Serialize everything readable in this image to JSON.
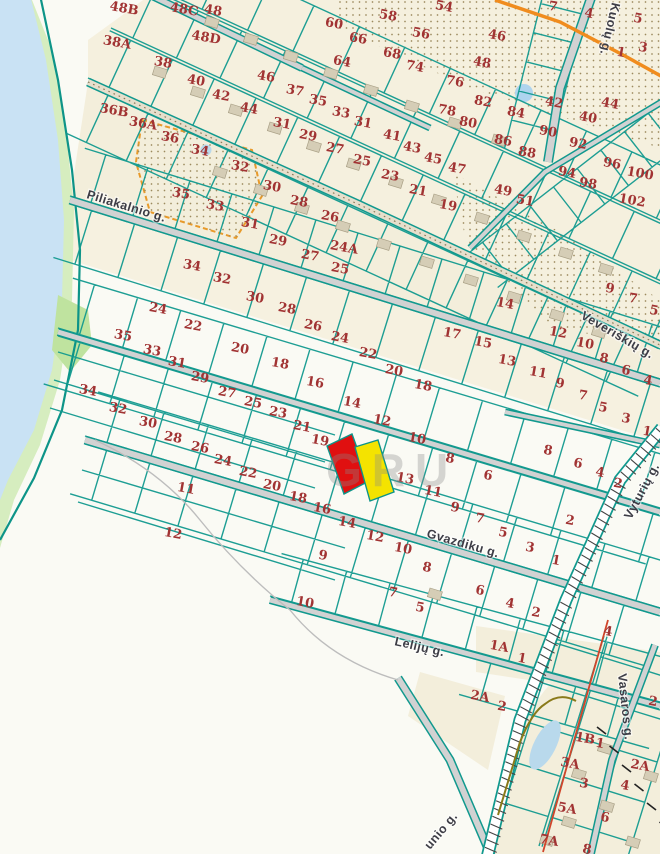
{
  "map": {
    "watermark": "GRU",
    "colors": {
      "parcel_line": "#11998e",
      "number": "#a13333",
      "street_label": "#3d3d46",
      "highlight_red": "#e01010",
      "highlight_yellow": "#f4e300",
      "road_fill": "#d2d2d2",
      "river": "#c9e2f4",
      "greenery": "#d6edbf",
      "beige": "#f3eedb",
      "orange_road": "#f08c1e",
      "watermark_gray": "#8a8a8a"
    },
    "streets": [
      {
        "name": "Piliakalnio g.",
        "x": 86,
        "y": 198,
        "rot": 17
      },
      {
        "name": "Gvazdiku g.",
        "x": 426,
        "y": 537,
        "rot": 16
      },
      {
        "name": "Lelijų g.",
        "x": 394,
        "y": 645,
        "rot": 13
      },
      {
        "name": "Veveriškių g.",
        "x": 580,
        "y": 318,
        "rot": 30
      },
      {
        "name": "Kuolų g.",
        "x": 612,
        "y": 2,
        "rot": 103
      },
      {
        "name": "Vyturių g.",
        "x": 631,
        "y": 520,
        "rot": -62
      },
      {
        "name": "Vasaros g.",
        "x": 618,
        "y": 674,
        "rot": 84
      },
      {
        "name": "unio g.",
        "x": 430,
        "y": 850,
        "rot": -50
      }
    ],
    "highlighted_parcels": [
      {
        "id": "selected-parcel-red",
        "color": "#e01010"
      },
      {
        "id": "adjacent-parcel-yellow",
        "color": "#f4e300"
      }
    ],
    "parcel_labels": [
      {
        "t": "48B",
        "x": 124,
        "y": 9
      },
      {
        "t": "48C",
        "x": 184,
        "y": 10
      },
      {
        "t": "48",
        "x": 213,
        "y": 11
      },
      {
        "t": "48D",
        "x": 206,
        "y": 38
      },
      {
        "t": "38A",
        "x": 117,
        "y": 43
      },
      {
        "t": "38",
        "x": 163,
        "y": 63
      },
      {
        "t": "40",
        "x": 196,
        "y": 81
      },
      {
        "t": "42",
        "x": 221,
        "y": 96
      },
      {
        "t": "44",
        "x": 249,
        "y": 109
      },
      {
        "t": "46",
        "x": 266,
        "y": 77
      },
      {
        "t": "36B",
        "x": 114,
        "y": 111
      },
      {
        "t": "36A",
        "x": 143,
        "y": 124
      },
      {
        "t": "36",
        "x": 170,
        "y": 138
      },
      {
        "t": "34",
        "x": 200,
        "y": 151
      },
      {
        "t": "32",
        "x": 240,
        "y": 167
      },
      {
        "t": "31",
        "x": 282,
        "y": 124
      },
      {
        "t": "30",
        "x": 272,
        "y": 187
      },
      {
        "t": "28",
        "x": 299,
        "y": 202
      },
      {
        "t": "26",
        "x": 330,
        "y": 217
      },
      {
        "t": "24A",
        "x": 344,
        "y": 248
      },
      {
        "t": "35",
        "x": 181,
        "y": 194
      },
      {
        "t": "33",
        "x": 215,
        "y": 206
      },
      {
        "t": "31",
        "x": 250,
        "y": 224
      },
      {
        "t": "29",
        "x": 278,
        "y": 241
      },
      {
        "t": "27",
        "x": 310,
        "y": 256
      },
      {
        "t": "25",
        "x": 340,
        "y": 269
      },
      {
        "t": "29",
        "x": 308,
        "y": 136
      },
      {
        "t": "27",
        "x": 335,
        "y": 149
      },
      {
        "t": "25",
        "x": 362,
        "y": 161
      },
      {
        "t": "23",
        "x": 390,
        "y": 176
      },
      {
        "t": "21",
        "x": 418,
        "y": 191
      },
      {
        "t": "19",
        "x": 448,
        "y": 206
      },
      {
        "t": "37",
        "x": 295,
        "y": 91
      },
      {
        "t": "35",
        "x": 318,
        "y": 101
      },
      {
        "t": "33",
        "x": 341,
        "y": 113
      },
      {
        "t": "31",
        "x": 363,
        "y": 123
      },
      {
        "t": "41",
        "x": 392,
        "y": 136
      },
      {
        "t": "43",
        "x": 412,
        "y": 148
      },
      {
        "t": "45",
        "x": 433,
        "y": 159
      },
      {
        "t": "47",
        "x": 457,
        "y": 169
      },
      {
        "t": "49",
        "x": 503,
        "y": 191
      },
      {
        "t": "51",
        "x": 525,
        "y": 201
      },
      {
        "t": "54",
        "x": 444,
        "y": 7
      },
      {
        "t": "56",
        "x": 421,
        "y": 34
      },
      {
        "t": "58",
        "x": 388,
        "y": 16
      },
      {
        "t": "60",
        "x": 334,
        "y": 24
      },
      {
        "t": "64",
        "x": 342,
        "y": 62
      },
      {
        "t": "66",
        "x": 358,
        "y": 39
      },
      {
        "t": "68",
        "x": 392,
        "y": 54
      },
      {
        "t": "74",
        "x": 415,
        "y": 67
      },
      {
        "t": "76",
        "x": 455,
        "y": 82
      },
      {
        "t": "78",
        "x": 447,
        "y": 111
      },
      {
        "t": "80",
        "x": 468,
        "y": 123
      },
      {
        "t": "82",
        "x": 483,
        "y": 102
      },
      {
        "t": "84",
        "x": 516,
        "y": 113
      },
      {
        "t": "86",
        "x": 503,
        "y": 141
      },
      {
        "t": "88",
        "x": 527,
        "y": 153
      },
      {
        "t": "90",
        "x": 548,
        "y": 132
      },
      {
        "t": "92",
        "x": 578,
        "y": 144
      },
      {
        "t": "94",
        "x": 567,
        "y": 173
      },
      {
        "t": "96",
        "x": 612,
        "y": 164
      },
      {
        "t": "98",
        "x": 588,
        "y": 184
      },
      {
        "t": "100",
        "x": 640,
        "y": 174
      },
      {
        "t": "102",
        "x": 632,
        "y": 201
      },
      {
        "t": "46",
        "x": 497,
        "y": 36
      },
      {
        "t": "48",
        "x": 482,
        "y": 63
      },
      {
        "t": "42",
        "x": 554,
        "y": 103
      },
      {
        "t": "40",
        "x": 588,
        "y": 118
      },
      {
        "t": "44",
        "x": 610,
        "y": 104
      },
      {
        "t": "7",
        "x": 553,
        "y": 7
      },
      {
        "t": "4",
        "x": 589,
        "y": 14
      },
      {
        "t": "5",
        "x": 638,
        "y": 19
      },
      {
        "t": "1",
        "x": 621,
        "y": 53
      },
      {
        "t": "3",
        "x": 643,
        "y": 48
      },
      {
        "t": "24",
        "x": 158,
        "y": 309
      },
      {
        "t": "22",
        "x": 193,
        "y": 326
      },
      {
        "t": "20",
        "x": 240,
        "y": 349
      },
      {
        "t": "18",
        "x": 280,
        "y": 364
      },
      {
        "t": "35",
        "x": 123,
        "y": 336
      },
      {
        "t": "33",
        "x": 152,
        "y": 351
      },
      {
        "t": "31",
        "x": 177,
        "y": 363
      },
      {
        "t": "34",
        "x": 88,
        "y": 391
      },
      {
        "t": "32",
        "x": 118,
        "y": 409
      },
      {
        "t": "30",
        "x": 148,
        "y": 423
      },
      {
        "t": "28",
        "x": 173,
        "y": 438
      },
      {
        "t": "34",
        "x": 192,
        "y": 266
      },
      {
        "t": "32",
        "x": 222,
        "y": 279
      },
      {
        "t": "30",
        "x": 255,
        "y": 298
      },
      {
        "t": "28",
        "x": 287,
        "y": 309
      },
      {
        "t": "26",
        "x": 313,
        "y": 326
      },
      {
        "t": "24",
        "x": 340,
        "y": 338
      },
      {
        "t": "22",
        "x": 368,
        "y": 354
      },
      {
        "t": "20",
        "x": 394,
        "y": 371
      },
      {
        "t": "18",
        "x": 423,
        "y": 386
      },
      {
        "t": "16",
        "x": 315,
        "y": 383
      },
      {
        "t": "14",
        "x": 352,
        "y": 403
      },
      {
        "t": "12",
        "x": 382,
        "y": 421
      },
      {
        "t": "10",
        "x": 417,
        "y": 439
      },
      {
        "t": "8",
        "x": 450,
        "y": 459
      },
      {
        "t": "6",
        "x": 488,
        "y": 476
      },
      {
        "t": "17",
        "x": 452,
        "y": 334
      },
      {
        "t": "15",
        "x": 483,
        "y": 343
      },
      {
        "t": "13",
        "x": 507,
        "y": 361
      },
      {
        "t": "11",
        "x": 538,
        "y": 373
      },
      {
        "t": "9",
        "x": 560,
        "y": 384
      },
      {
        "t": "7",
        "x": 583,
        "y": 396
      },
      {
        "t": "5",
        "x": 603,
        "y": 408
      },
      {
        "t": "3",
        "x": 626,
        "y": 419
      },
      {
        "t": "1",
        "x": 647,
        "y": 432
      },
      {
        "t": "14",
        "x": 505,
        "y": 304
      },
      {
        "t": "12",
        "x": 558,
        "y": 333
      },
      {
        "t": "10",
        "x": 585,
        "y": 344
      },
      {
        "t": "8",
        "x": 604,
        "y": 359
      },
      {
        "t": "6",
        "x": 626,
        "y": 371
      },
      {
        "t": "4",
        "x": 648,
        "y": 381
      },
      {
        "t": "9",
        "x": 610,
        "y": 289
      },
      {
        "t": "7",
        "x": 633,
        "y": 299
      },
      {
        "t": "5",
        "x": 654,
        "y": 311
      },
      {
        "t": "29",
        "x": 200,
        "y": 378
      },
      {
        "t": "27",
        "x": 227,
        "y": 393
      },
      {
        "t": "25",
        "x": 253,
        "y": 403
      },
      {
        "t": "23",
        "x": 278,
        "y": 413
      },
      {
        "t": "21",
        "x": 302,
        "y": 427
      },
      {
        "t": "19",
        "x": 320,
        "y": 441
      },
      {
        "t": "26",
        "x": 200,
        "y": 448
      },
      {
        "t": "24",
        "x": 223,
        "y": 461
      },
      {
        "t": "22",
        "x": 248,
        "y": 473
      },
      {
        "t": "20",
        "x": 272,
        "y": 486
      },
      {
        "t": "18",
        "x": 298,
        "y": 498
      },
      {
        "t": "16",
        "x": 322,
        "y": 509
      },
      {
        "t": "11",
        "x": 186,
        "y": 489
      },
      {
        "t": "12",
        "x": 173,
        "y": 534
      },
      {
        "t": "9",
        "x": 323,
        "y": 556
      },
      {
        "t": "10",
        "x": 305,
        "y": 603
      },
      {
        "t": "13",
        "x": 405,
        "y": 479
      },
      {
        "t": "11",
        "x": 433,
        "y": 492
      },
      {
        "t": "9",
        "x": 455,
        "y": 508
      },
      {
        "t": "7",
        "x": 480,
        "y": 519
      },
      {
        "t": "5",
        "x": 503,
        "y": 533
      },
      {
        "t": "3",
        "x": 530,
        "y": 548
      },
      {
        "t": "1",
        "x": 556,
        "y": 561
      },
      {
        "t": "8",
        "x": 548,
        "y": 451
      },
      {
        "t": "6",
        "x": 578,
        "y": 464
      },
      {
        "t": "4",
        "x": 600,
        "y": 473
      },
      {
        "t": "2",
        "x": 618,
        "y": 484
      },
      {
        "t": "2",
        "x": 570,
        "y": 521
      },
      {
        "t": "14",
        "x": 347,
        "y": 523
      },
      {
        "t": "12",
        "x": 375,
        "y": 537
      },
      {
        "t": "10",
        "x": 403,
        "y": 549
      },
      {
        "t": "8",
        "x": 427,
        "y": 568
      },
      {
        "t": "6",
        "x": 480,
        "y": 591
      },
      {
        "t": "4",
        "x": 510,
        "y": 604
      },
      {
        "t": "2",
        "x": 536,
        "y": 613
      },
      {
        "t": "7",
        "x": 393,
        "y": 593
      },
      {
        "t": "5",
        "x": 420,
        "y": 608
      },
      {
        "t": "1A",
        "x": 499,
        "y": 647
      },
      {
        "t": "1",
        "x": 522,
        "y": 659
      },
      {
        "t": "2A",
        "x": 480,
        "y": 697
      },
      {
        "t": "2",
        "x": 502,
        "y": 707
      },
      {
        "t": "4",
        "x": 608,
        "y": 632
      },
      {
        "t": "2",
        "x": 653,
        "y": 702
      },
      {
        "t": "1B",
        "x": 585,
        "y": 739
      },
      {
        "t": "1",
        "x": 600,
        "y": 744
      },
      {
        "t": "3A",
        "x": 570,
        "y": 764
      },
      {
        "t": "3",
        "x": 584,
        "y": 784
      },
      {
        "t": "2A",
        "x": 640,
        "y": 766
      },
      {
        "t": "4",
        "x": 625,
        "y": 786
      },
      {
        "t": "5A",
        "x": 567,
        "y": 809
      },
      {
        "t": "6",
        "x": 605,
        "y": 818
      },
      {
        "t": "7A",
        "x": 549,
        "y": 841
      },
      {
        "t": "8",
        "x": 587,
        "y": 850
      }
    ]
  }
}
